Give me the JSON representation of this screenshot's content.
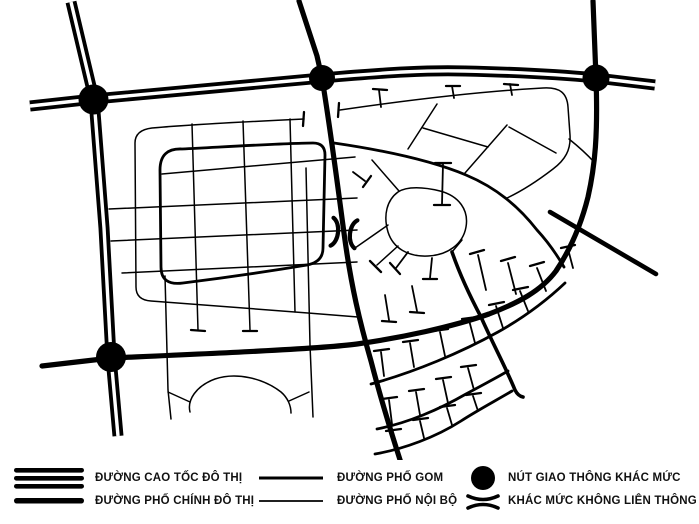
{
  "diagram": {
    "type": "urban-road-network-schematic",
    "background_color": "#ffffff",
    "road_color": "#000000",
    "junction_count": 4,
    "grade_separation_marker_count": 1
  },
  "legend": {
    "text_color": "#111111",
    "items": [
      {
        "id": "expressway",
        "symbol": "triple-thick-line",
        "label": "ĐƯỜNG CAO TỐC ĐÔ THỊ"
      },
      {
        "id": "main-street",
        "symbol": "single-thick-line",
        "label": "ĐƯỜNG PHỐ CHÍNH ĐÔ THỊ"
      },
      {
        "id": "collector-street",
        "symbol": "medium-line",
        "label": "ĐƯỜNG PHỐ GOM"
      },
      {
        "id": "internal-street",
        "symbol": "thin-line",
        "label": "ĐƯỜNG PHỐ NỘI BỘ"
      },
      {
        "id": "grade-separated-interchange",
        "symbol": "filled-circle",
        "label": "NÚT GIAO THÔNG KHÁC MỨC"
      },
      {
        "id": "grade-separation-no-link",
        "symbol": "double-arc",
        "label": "KHÁC MỨC KHÔNG LIÊN THÔNG"
      }
    ]
  }
}
